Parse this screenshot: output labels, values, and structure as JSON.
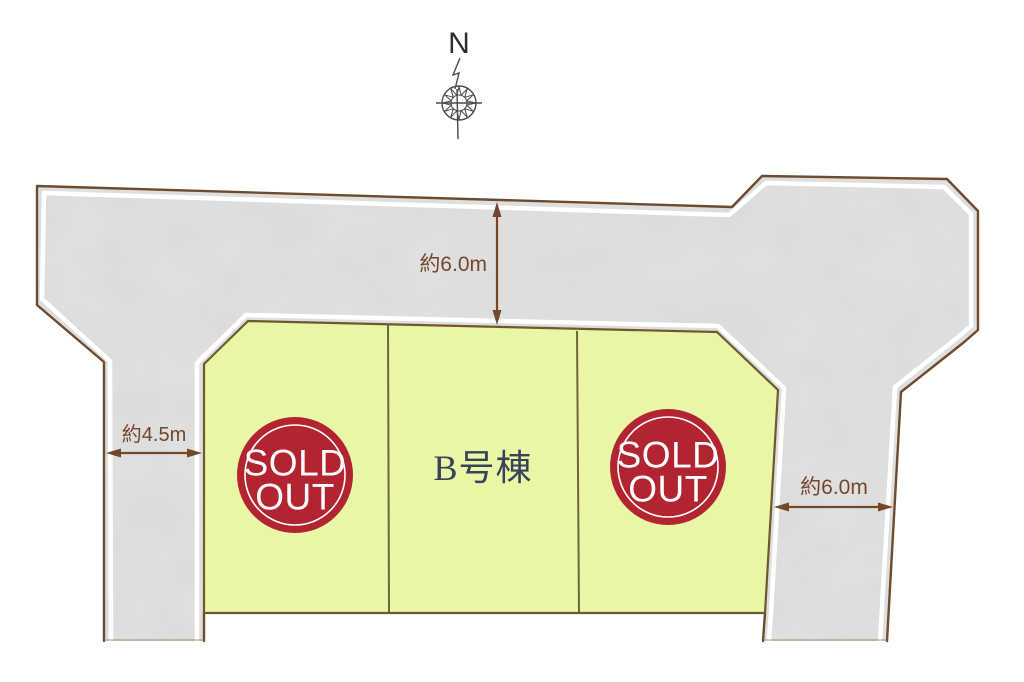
{
  "plan": {
    "type_note": "residential lot site plan"
  },
  "compass": {
    "north_label": "N"
  },
  "dimensions": {
    "top_road": "約6.0m",
    "left_road": "約4.5m",
    "right_road": "約6.0m"
  },
  "lots": {
    "left": {
      "badge": [
        "SOLD",
        "OUT"
      ]
    },
    "middle": {
      "label": "B号棟"
    },
    "right": {
      "badge": [
        "SOLD",
        "OUT"
      ]
    }
  },
  "colors": {
    "road_fill": "#cdcdcd",
    "road_border": "#6e4a2f",
    "walk_line": "#ffffff",
    "lot_fill": "#e9f6a6",
    "lot_border": "#6f572e",
    "lot_divider": "#6b673d",
    "sold_badge": "#b32431",
    "sold_text": "#ffffff",
    "dimension_text": "#74472a",
    "unit_label_text": "#374358"
  }
}
